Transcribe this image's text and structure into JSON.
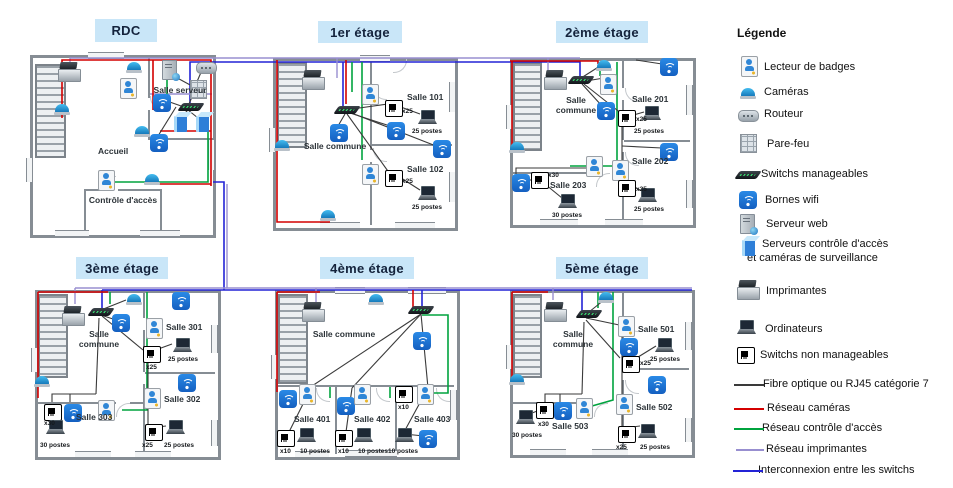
{
  "colors": {
    "fiber": "#3a3a3a",
    "camera_network": "#d40000",
    "access_network": "#00a33e",
    "printer_network": "#988fd0",
    "interconnect": "#2323d6",
    "title_bg": "#c9e6f8",
    "title_text": "#14233c",
    "wifi_blue": "#1c7fe0"
  },
  "legend": {
    "title": "Légende",
    "items": [
      {
        "icon": "badge-reader-icon",
        "label": "Lecteur de badges"
      },
      {
        "icon": "camera-icon",
        "label": "Caméras"
      },
      {
        "icon": "router-icon",
        "label": "Routeur"
      },
      {
        "icon": "firewall-icon",
        "label": "Pare-feu"
      },
      {
        "icon": "managed-switch-icon",
        "label": "Switchs manageables"
      },
      {
        "icon": "wifi-ap-icon",
        "label": "Bornes wifi"
      },
      {
        "icon": "web-server-icon",
        "label": "Serveur web"
      },
      {
        "icon": "access-server-icon",
        "label": "Serveurs contrôle d'accès",
        "label2": "et caméras de surveillance"
      },
      {
        "icon": "printer-icon",
        "label": "Imprimantes"
      },
      {
        "icon": "computer-icon",
        "label": "Ordinateurs"
      },
      {
        "icon": "unmanaged-switch-icon",
        "label": "Switchs non manageables"
      }
    ],
    "lines": [
      {
        "label": "Fibre optique ou RJ45 catégorie 7"
      },
      {
        "label": "Réseau caméras"
      },
      {
        "label": "Réseau contrôle d'accès"
      },
      {
        "label": "Réseau imprimantes"
      },
      {
        "label": "Interconnexion entre les switchs"
      }
    ]
  },
  "floors": [
    {
      "title": "RDC",
      "rooms": {
        "server": "Salle serveur",
        "lobby": "Accueil",
        "access": "Contrôle d'accès"
      }
    },
    {
      "title": "1er étage",
      "common": "Salle commune",
      "rooms": [
        {
          "name": "Salle 101",
          "switch": "x25",
          "postes": "25 postes"
        },
        {
          "name": "Salle 102",
          "switch": "x25",
          "postes": "25 postes"
        }
      ]
    },
    {
      "title": "2ème étage",
      "common": "Salle commune",
      "rooms": [
        {
          "name": "Salle 201",
          "switch": "x25",
          "postes": "25 postes"
        },
        {
          "name": "Salle 202",
          "switch": "x25",
          "postes": "25 postes"
        },
        {
          "name": "Salle 203",
          "switch": "x30",
          "postes": "30 postes"
        }
      ]
    },
    {
      "title": "3ème étage",
      "common": "Salle commune",
      "rooms": [
        {
          "name": "Salle 301",
          "switch": "x25",
          "postes": "25 postes"
        },
        {
          "name": "Salle 302",
          "switch": "x25",
          "postes": "25 postes"
        },
        {
          "name": "Salle 303",
          "switch": "x30",
          "postes": "30 postes"
        }
      ]
    },
    {
      "title": "4ème étage",
      "common": "Salle commune",
      "rooms": [
        {
          "name": "Salle 401",
          "switch": "x10",
          "postes": "10 postes"
        },
        {
          "name": "Salle 402",
          "switch": "x10",
          "postes": "10 postes"
        },
        {
          "name": "Salle 403",
          "switch": "x10",
          "postes": "10 postes"
        }
      ]
    },
    {
      "title": "5ème étage",
      "common": "Salle commune",
      "rooms": [
        {
          "name": "Salle 501",
          "switch": "x25",
          "postes": "25 postes"
        },
        {
          "name": "Salle 502",
          "switch": "x25",
          "postes": "25 postes"
        },
        {
          "name": "Salle 503",
          "switch": "x30",
          "postes": "30 postes"
        }
      ]
    }
  ]
}
